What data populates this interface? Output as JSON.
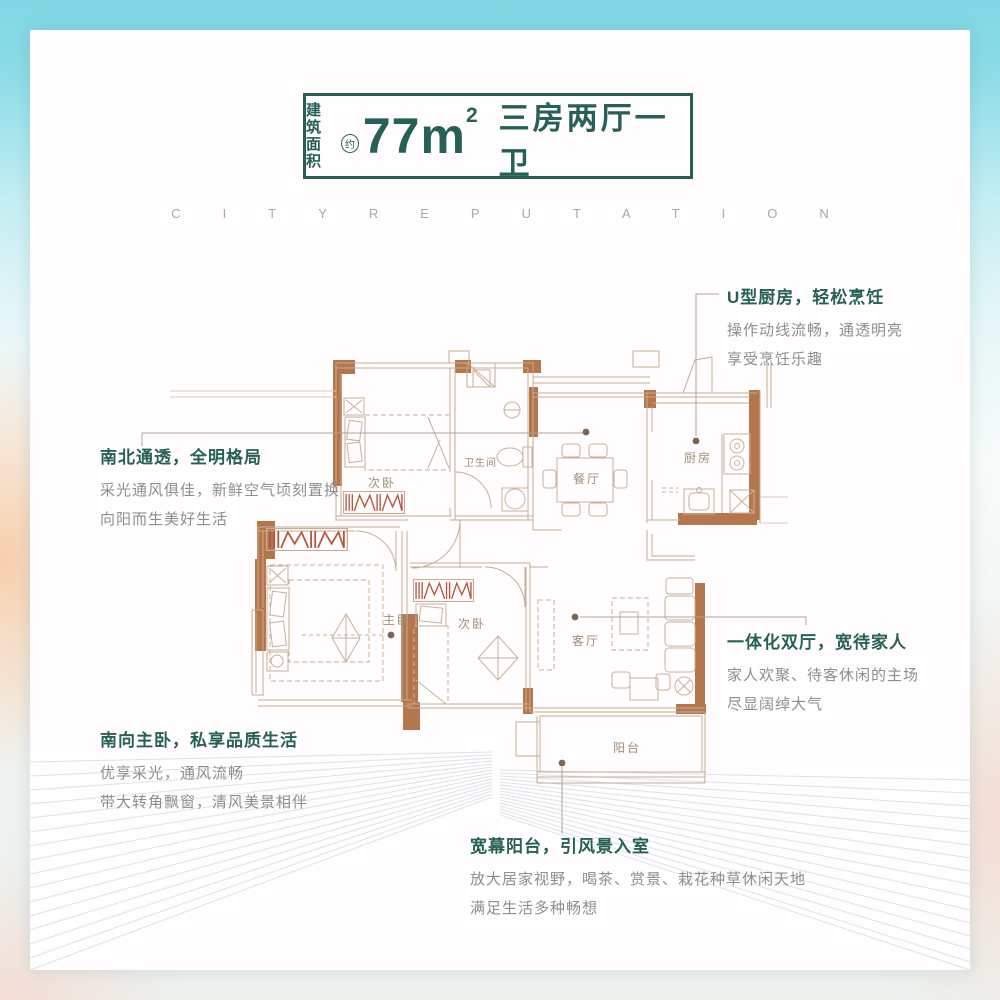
{
  "header": {
    "area_label_line1": "建筑",
    "area_label_line2": "面积",
    "approx": "约",
    "area_value": "77",
    "area_unit": "m",
    "area_sup": "2",
    "layout_text": "三房两厅一卫"
  },
  "watermark": "CITYREPUTATION",
  "plan": {
    "room_labels": {
      "bedroom_top": "次卧",
      "bathroom": "卫生间",
      "dining": "餐厅",
      "kitchen": "厨房",
      "master": "主卧",
      "bedroom_mid": "次卧",
      "living": "客厅",
      "balcony": "阳台"
    }
  },
  "annotations": {
    "bright": {
      "title": "南北通透，全明格局",
      "line1": "采光通风俱佳，新鲜空气顷刻置换",
      "line2": "向阳而生美好生活"
    },
    "kitchen": {
      "title": "U型厨房，轻松烹饪",
      "line1": "操作动线流畅，通透明亮",
      "line2": "享受烹饪乐趣"
    },
    "living": {
      "title": "一体化双厅，宽待家人",
      "line1": "家人欢聚、待客休闲的主场",
      "line2": "尽显阔绰大气"
    },
    "master": {
      "title": "南向主卧，私享品质生活",
      "line1": "优享采光，通风流畅",
      "line2": "带大转角飘窗，清风美景相伴"
    },
    "balcony": {
      "title": "宽幕阳台，引风景入室",
      "line1": "放大居家视野，喝茶、赏景、栽花种草休闲天地",
      "line2": "满足生活多种畅想"
    }
  },
  "colors": {
    "accent_teal": "#276056",
    "wall_brown": "#b3764d",
    "window_red": "#b5543b",
    "line_brown": "#c9ab94",
    "body_gray": "#8a908d"
  }
}
